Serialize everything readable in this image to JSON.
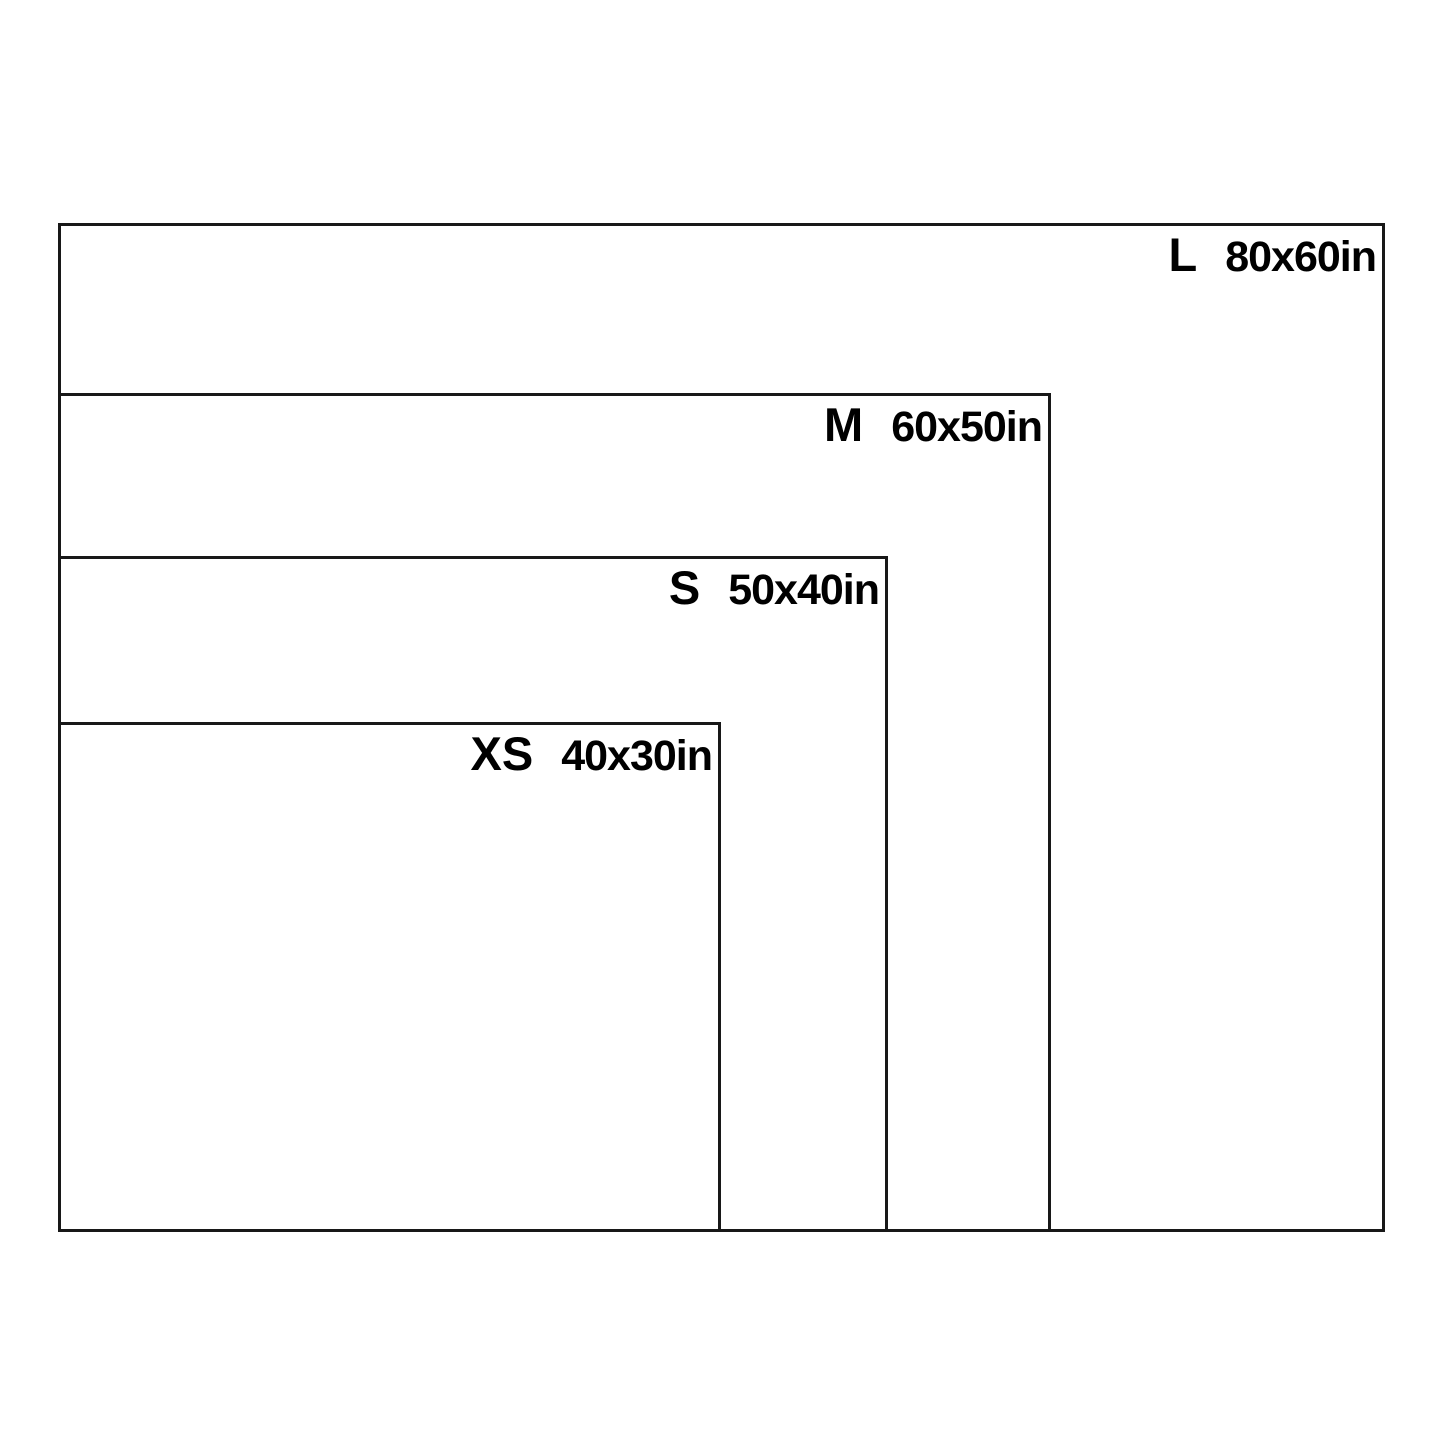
{
  "canvas": {
    "background": "#ffffff",
    "line_color": "#181818",
    "text_color": "#000000"
  },
  "chart_data": {
    "type": "diagram",
    "description": "nested-rectangles-size-comparison",
    "unit": "in",
    "sizes": [
      {
        "label": "L",
        "dimensions": "80x60in",
        "width_in": 80,
        "height_in": 60,
        "box_px": {
          "left": 58,
          "top": 223,
          "width": 1327,
          "height": 1009
        }
      },
      {
        "label": "M",
        "dimensions": "60x50in",
        "width_in": 60,
        "height_in": 50,
        "box_px": {
          "left": 58,
          "top": 393,
          "width": 993,
          "height": 839
        }
      },
      {
        "label": "S",
        "dimensions": "50x40in",
        "width_in": 50,
        "height_in": 40,
        "box_px": {
          "left": 58,
          "top": 556,
          "width": 830,
          "height": 676
        }
      },
      {
        "label": "XS",
        "dimensions": "40x30in",
        "width_in": 40,
        "height_in": 30,
        "box_px": {
          "left": 58,
          "top": 722,
          "width": 663,
          "height": 510
        }
      }
    ]
  }
}
